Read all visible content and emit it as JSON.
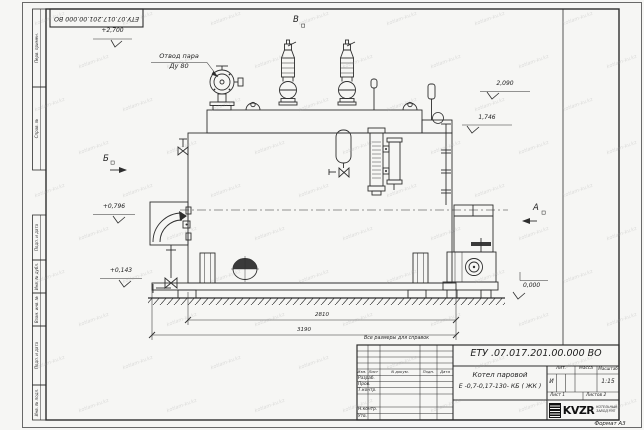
{
  "sheet": {
    "doc_number_rotated": "ЕТУ.07.017.201.00.000  ВО",
    "format_note": "Формат А3",
    "reference_note": "Все размеры для справок",
    "watermark_text": "kotlam-kv.kz",
    "margin_labels": {
      "perv_primen": "Перв. примен.",
      "sprav_no": "Справ. №",
      "podp_data_1": "Подп. и дата",
      "inv_dubl": "Инв. № дубл.",
      "vzam_inv": "Взам. инв. №",
      "podp_data_2": "Подп. и дата",
      "inv_podl": "Инв. № подл."
    }
  },
  "drawing": {
    "callout_steam": {
      "line1": "Отвод пара",
      "line2": "Ду 80"
    },
    "section_marks": {
      "v": "В",
      "b": "Б",
      "a": "А"
    },
    "elevations": {
      "top": "+2,700",
      "right_upper": "2,090",
      "right_lower": "1,746",
      "left_upper": "+0,796",
      "left_lower": "+0,143",
      "ground": "0,000"
    },
    "dimensions": {
      "inner": "2810",
      "overall": "3190"
    }
  },
  "title_block": {
    "doc_number": "ЕТУ .07.017.201.00.000  ВО",
    "product_name_line1": "Котел паровой",
    "product_name_line2": "Е -0,7-0,17-130- КБ ( ЖК )",
    "header": {
      "izm": "Изм.",
      "list": "Лист",
      "n_dokum": "N докум.",
      "podp": "Подп.",
      "data": "Дата"
    },
    "rows": {
      "razrab": "Разраб.",
      "prov": "Пров.",
      "t_kontr": "Т.контр.",
      "n_kontr": "Н.контр.",
      "utv": "Утв."
    },
    "lit_header": "Лит.",
    "massa_header": "Масса",
    "masshtab_header": "Масштаб",
    "lit_value": "И",
    "scale_value": "1:15",
    "sheet_label": "Лист",
    "sheet_value": "1",
    "sheets_label": "Листов",
    "sheets_value": "2",
    "logo_text": "KVZR",
    "logo_sub_line1": "КОТЕЛЬНЫЙ",
    "logo_sub_line2": "ЗАВОД РЭП"
  }
}
